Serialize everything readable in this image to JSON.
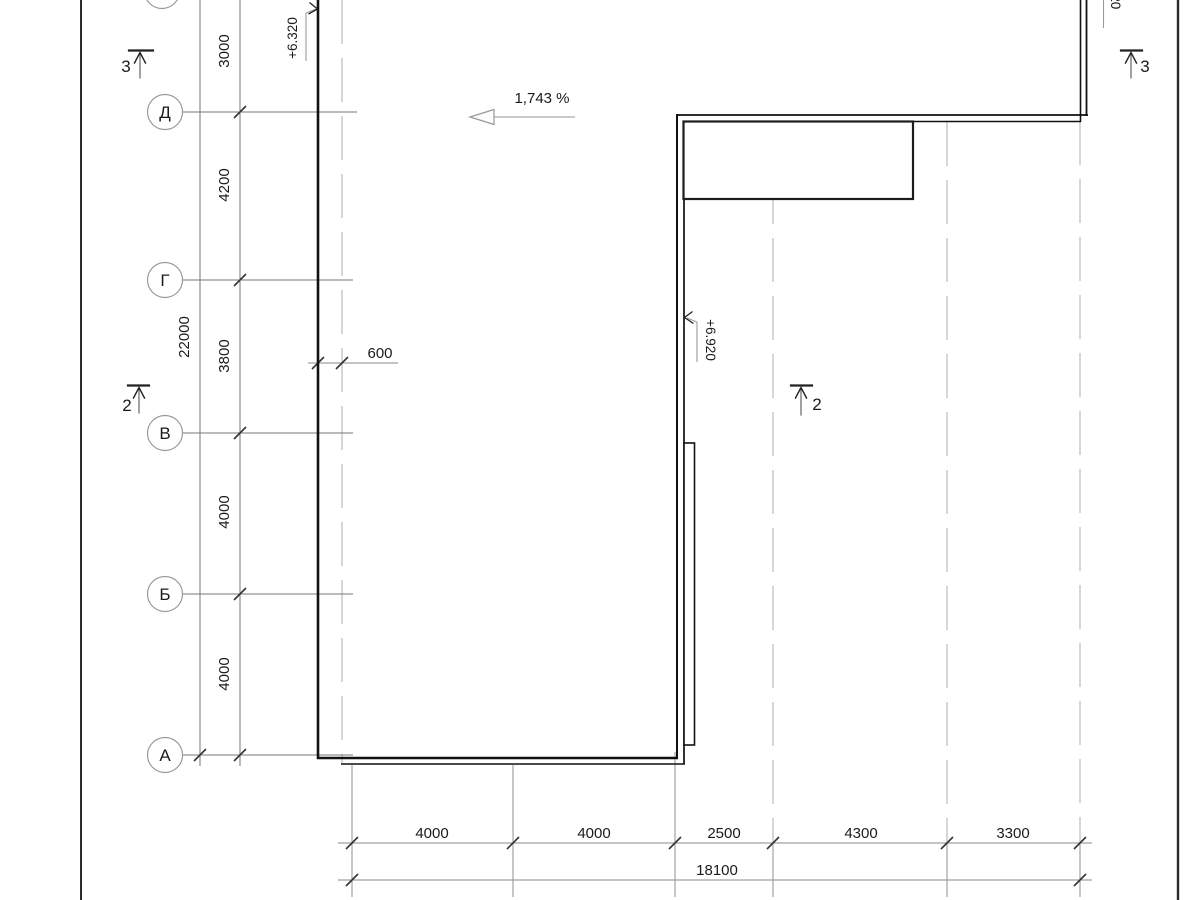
{
  "axes": {
    "rows": [
      {
        "label": "Д"
      },
      {
        "label": "Г"
      },
      {
        "label": "В"
      },
      {
        "label": "Б"
      },
      {
        "label": "А"
      }
    ]
  },
  "dims_left": {
    "segments": [
      "3000",
      "4200",
      "3800",
      "4000",
      "4000"
    ],
    "total": "22000"
  },
  "dims_bottom": {
    "segments": [
      "4000",
      "4000",
      "2500",
      "4300",
      "3300"
    ],
    "total": "18100"
  },
  "dims_other": {
    "edge_offset": "600"
  },
  "slope": {
    "label": "1,743 %"
  },
  "elevations": {
    "left": "+6.320",
    "inner": "+6.920",
    "top_right_partial": "020"
  },
  "sections": {
    "top_left": "3",
    "top_right": "3",
    "left": "2",
    "right": "2"
  }
}
